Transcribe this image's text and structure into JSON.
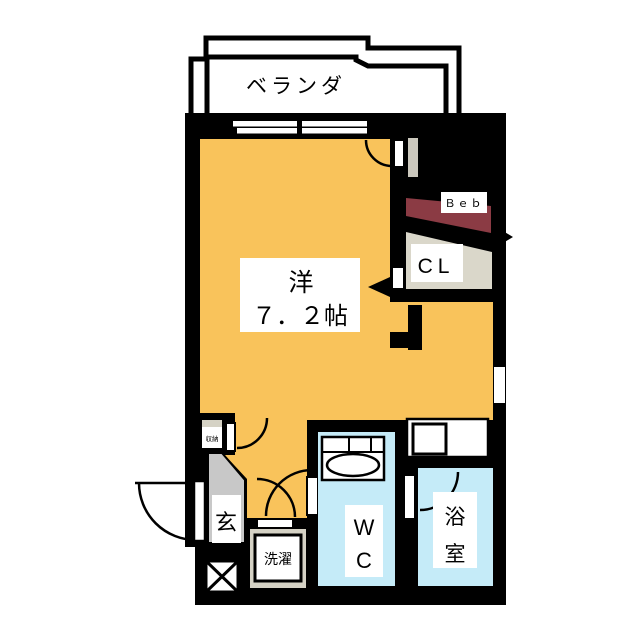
{
  "plan": {
    "balcony": {
      "label": "ベランダ"
    },
    "living": {
      "label": "洋",
      "size": "７．２帖"
    },
    "bed": {
      "label": "Ｂｅｂ"
    },
    "closet": {
      "label": "CL"
    },
    "entrance": {
      "label": "玄"
    },
    "storage": {
      "label": "収納"
    },
    "laundry": {
      "label": "洗濯"
    },
    "wc": {
      "line1": "W",
      "line2": "C"
    },
    "bath": {
      "line1": "浴",
      "line2": "室"
    }
  },
  "colors": {
    "wall": "#000000",
    "room_floor": "#F9C35B",
    "wet_area": "#C5EBF8",
    "bed_area": "#8B3B44",
    "closet_area": "#DAD7CA",
    "entrance_floor": "#C8C8C8",
    "fixture_beige": "#D5D2C5",
    "duct_gray": "#CBC8BD"
  }
}
